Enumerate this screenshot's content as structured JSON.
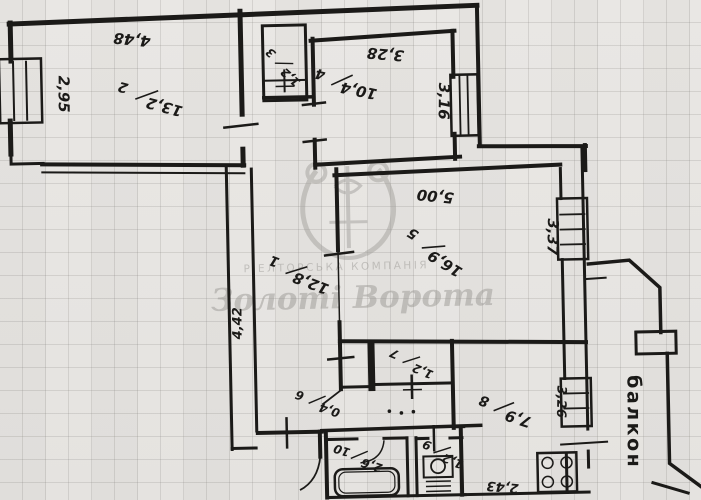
{
  "plan": {
    "type": "apartment floor plan (scanned BTI drawing)",
    "balcony_label": "балкон",
    "watermark": {
      "company_type": "РІЕЛТОРСЬКА КОМПАНІЯ",
      "company_name": "Золоті Ворота"
    },
    "rooms": [
      {
        "number": "1",
        "area": "12,8"
      },
      {
        "number": "2",
        "area": "13,2"
      },
      {
        "number": "3",
        "area": "1,2"
      },
      {
        "number": "4",
        "area": "10,4"
      },
      {
        "number": "5",
        "area": "16,9"
      },
      {
        "number": "6",
        "area": "0,4"
      },
      {
        "number": "7",
        "area": "1,2"
      },
      {
        "number": "8",
        "area": "7,9"
      },
      {
        "number": "9",
        "area": "1,2"
      },
      {
        "number": "10",
        "area": "2,6"
      }
    ],
    "dimensions": [
      {
        "value": "4,48",
        "loc": "room2-top"
      },
      {
        "value": "2,95",
        "loc": "room2-left"
      },
      {
        "value": "3,28",
        "loc": "room4-top"
      },
      {
        "value": "3,16",
        "loc": "room4-right"
      },
      {
        "value": "5,00",
        "loc": "room5-top"
      },
      {
        "value": "3,37",
        "loc": "room5-right"
      },
      {
        "value": "4,42",
        "loc": "hall-left"
      },
      {
        "value": "3,26",
        "loc": "kitchen-right"
      },
      {
        "value": "2,43",
        "loc": "kitchen-bottom"
      }
    ]
  }
}
